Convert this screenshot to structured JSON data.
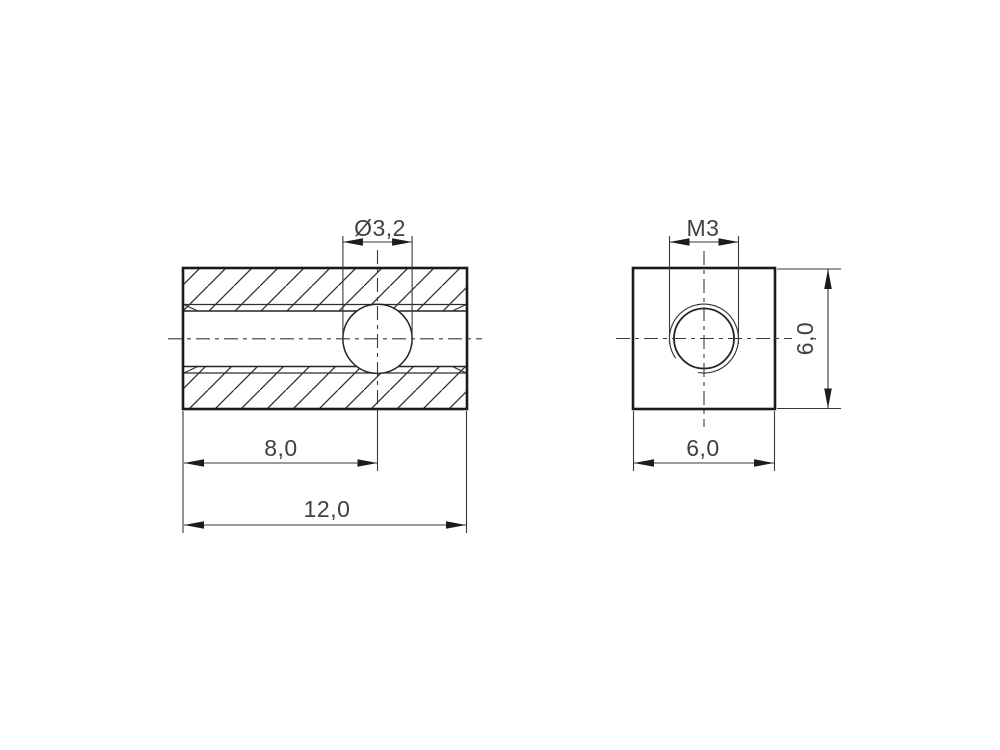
{
  "drawing": {
    "background": "#ffffff",
    "outline_color": "#1a1a1a",
    "thin_line_color": "#2e2e2e",
    "dim_line_color": "#3a3a3a",
    "text_color": "#404040",
    "side_view": {
      "hole_diameter_label": "Ø3,2",
      "hole_position_label": "8,0",
      "length_label": "12,0"
    },
    "end_view": {
      "thread_label": "M3",
      "width_label": "6,0",
      "height_label": "6,0"
    }
  }
}
